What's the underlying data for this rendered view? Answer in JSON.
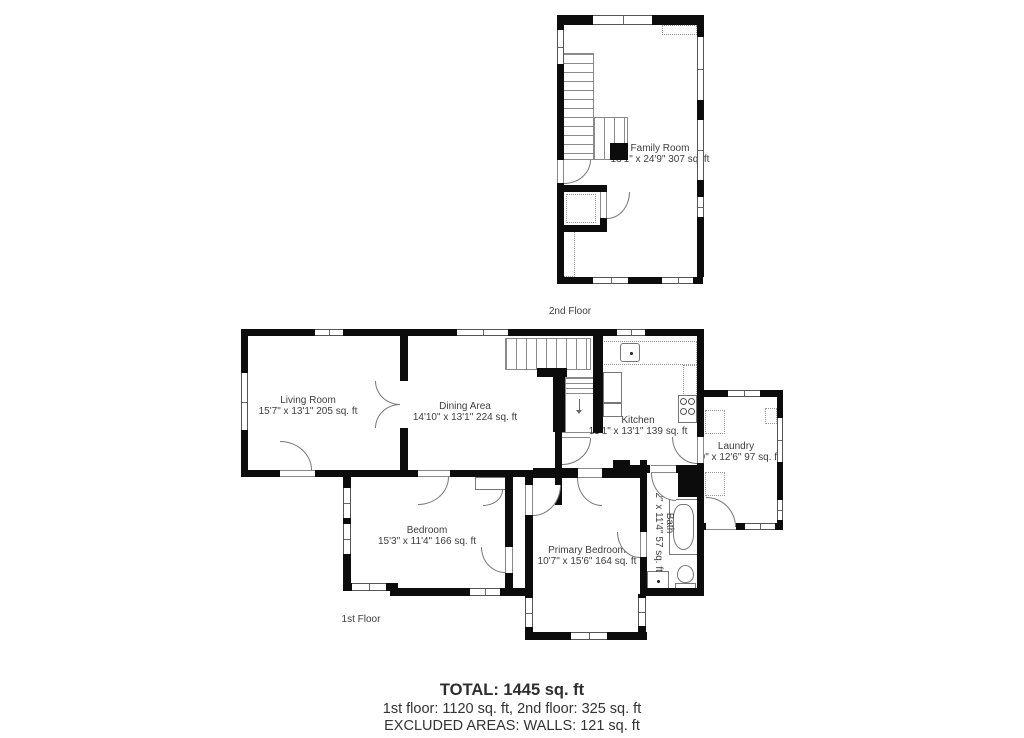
{
  "floors": {
    "second": {
      "caption": "2nd Floor",
      "rooms": [
        {
          "name": "Family Room",
          "dims": "13'1\" x 24'9\" 307 sq. ft"
        }
      ]
    },
    "first": {
      "caption": "1st Floor",
      "rooms": [
        {
          "name": "Living Room",
          "dims": "15'7\" x 13'1\" 205 sq. ft"
        },
        {
          "name": "Dining Area",
          "dims": "14'10\" x 13'1\" 224 sq. ft"
        },
        {
          "name": "Kitchen",
          "dims": "13'1\" x 13'1\" 139 sq. ft"
        },
        {
          "name": "Laundry",
          "dims": "7'9\" x 12'6\" 97 sq. ft"
        },
        {
          "name": "Bedroom",
          "dims": "15'3\" x 11'4\" 166 sq. ft"
        },
        {
          "name": "Primary Bedroom",
          "dims": "10'7\" x 15'6\" 164 sq. ft"
        },
        {
          "name": "Bath",
          "dims": "5'2\" x 11'4\" 57 sq. ft"
        }
      ]
    }
  },
  "summary": {
    "total": "TOTAL: 1445 sq. ft",
    "floors": "1st floor: 1120 sq. ft, 2nd floor: 325 sq. ft",
    "excluded": "EXCLUDED AREAS: WALLS: 121 sq. ft"
  },
  "colors": {
    "wall": "#0c0c0c",
    "line": "#777777",
    "text": "#3d3d3d"
  }
}
